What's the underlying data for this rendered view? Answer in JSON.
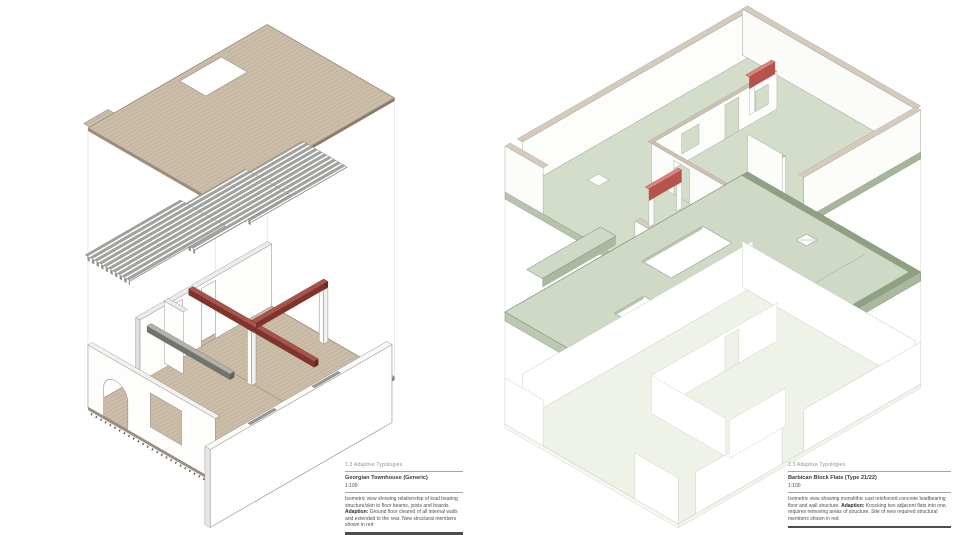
{
  "sheet": {
    "background": "#ffffff",
    "section_header": "1.3 Adaptive Typologies"
  },
  "colors": {
    "wood_floor": "#cbbda8",
    "wood_stripe": "#ab9c86",
    "wood_edge": "#857766",
    "joist_grey": "#a2a29e",
    "new_structure_red_face": "#7e332c",
    "new_structure_red_top": "#a8544b",
    "red_wall_highlight_top": "#db837c",
    "red_wall_highlight_face": "#b4544c",
    "slab_green_top": "#cfd9c5",
    "slab_green_edge_band": "#8fa182",
    "slab_green_outline": "#74856a",
    "wall_white": "#fdfdfc",
    "wall_cap_tan": "#d4cabd",
    "wall_outline_grey": "#a3a39e",
    "ghost_outline": "#c9d1c3",
    "caption_text": "#4f4f4f",
    "caption_bar": "#4d4d4d"
  },
  "left": {
    "caption": {
      "section": "1.3 Adaptive Typologies",
      "title": "Georgian Townhouse (Generic)",
      "scale": "1:100",
      "body_1": "Isometric view showing relationship of load bearing structure/skin to floor beams, joists and boards.",
      "adaption_label": "Adaption:",
      "body_2": "Ground floor cleared of all internal walls and extended to the rear. New structural members shown in red"
    }
  },
  "right": {
    "caption": {
      "section": "1.3 Adaptive Typologies",
      "title": "Barbican Block Flats (Type 21/22)",
      "scale": "1:100",
      "body_1": "Isometric view showing monolithic cast reinforced concrete loadbearing floor and wall structure.",
      "adaption_label": "Adaption:",
      "body_2": "Knocking two adjacent flats into one, requires removing areas of structure. Site of new required structural members shown in red"
    }
  }
}
